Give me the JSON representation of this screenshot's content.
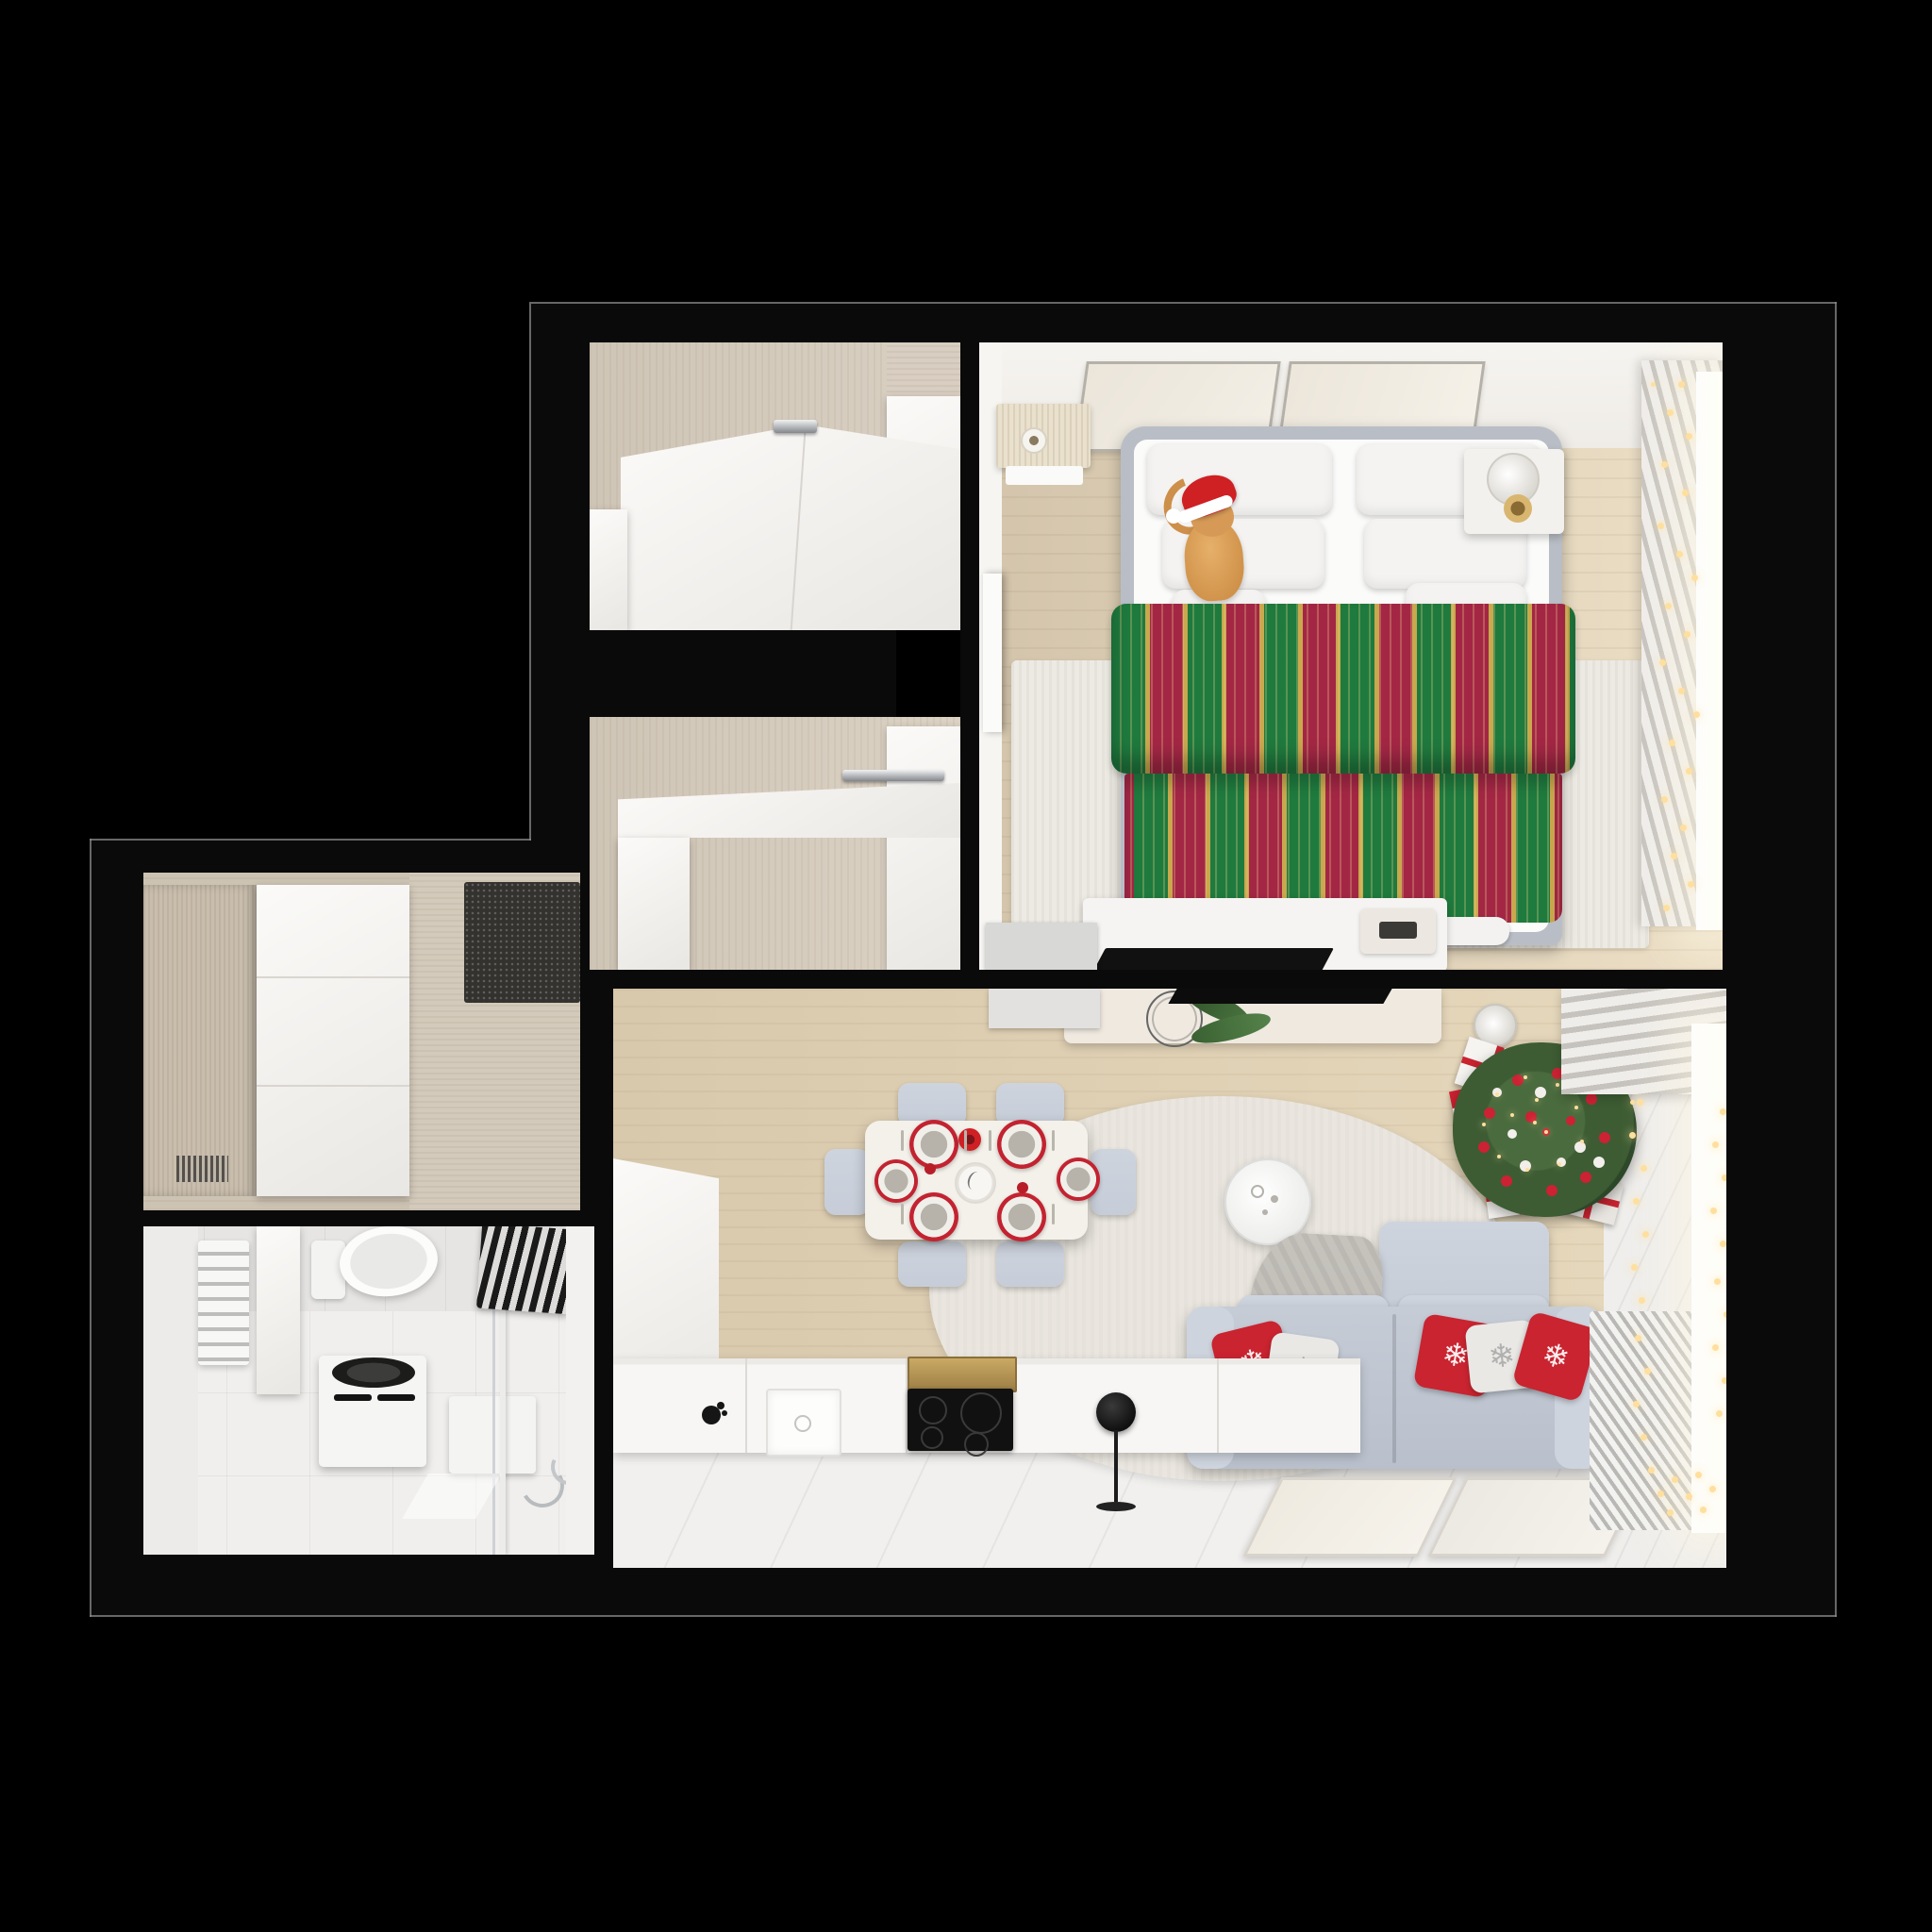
{
  "meta": {
    "title": "Top-down 3D render of a one-bedroom apartment floor plan with Christmas decorations",
    "view": "orthographic top-down",
    "style": "photorealistic architectural render on black background"
  },
  "palette": {
    "background": "#000000",
    "wall": "#0a0a0a",
    "outline": "#8a8a8a",
    "closet_floor": "#cfc5b6",
    "closet_wall": "#d8cec1",
    "bedroom_floor": "#d3c4ab",
    "bedroom_wall_band": "#f4f2ee",
    "hall_floor": "#cdc3b3",
    "bath_floor": "#f0efed",
    "bath_tile": "#e6e5e3",
    "living_floor": "#d8c8ac",
    "living_floor_white": "#f1f0ee",
    "cabinet_white": "#f7f6f4",
    "chrome": "#b9bcc0",
    "bed_frame": "#b9bec6",
    "mattress": "#fbfbfa",
    "pillow": "#f4f3f1",
    "blanket_green": "#1f7a3e",
    "blanket_red": "#a32745",
    "blanket_gold": "#c9a84e",
    "cat_fur": "#d79a56",
    "santa_red": "#cf2024",
    "rug": "#edeae3",
    "arc_rug": "#eae6df",
    "sofa": "#c6ccd6",
    "sofa_light": "#ced4de",
    "pillow_red": "#c92430",
    "pillow_white": "#e9e8e5",
    "throw_gray": "#bdbab4",
    "tree_green": "#3d5c33",
    "tree_dark": "#2c4628",
    "ornament_red": "#cc2233",
    "ornament_white": "#f2efec",
    "light_warm": "#ffdf9e",
    "table_white": "#f4f1ea",
    "chair_gray": "#c7cdd8",
    "plate_red": "#c32331",
    "plate_center": "#b7b3aa",
    "curtain_light": "#efedea",
    "curtain_dark": "#c6c3be",
    "radiator": "#f2f2f0",
    "radiator_dark": "#b9b8b5",
    "doormat": "#34322e",
    "appliance_black": "#111111",
    "hood_brass": "#b5924f",
    "console_cream": "#efe9e0",
    "window_white": "#ffffff",
    "gray_door": "#d8d8d6"
  },
  "rooms": {
    "walk_in_closet": {
      "name": "walk-in closet with white wardrobe"
    },
    "storage_closet": {
      "name": "second closet with built-in desk"
    },
    "bedroom": {
      "name": "bedroom with double bed, cat in santa hat, window garland"
    },
    "hallway": {
      "name": "entry hallway with wardrobe and doormat"
    },
    "bathroom": {
      "name": "bathroom with toilet, washing machine, radiator and shower"
    },
    "living_kitchen": {
      "name": "living room with kitchen, dining table, sofa and christmas tree"
    }
  },
  "objects": {
    "bedroom_items": [
      "double bed",
      "green-red striped holiday blanket",
      "six white pillows",
      "ginger cat wearing santa hat",
      "left nightstand with mug",
      "right nightstand with lamp and candle",
      "two wall art frames",
      "striped area rug",
      "dresser with flat tv",
      "digital clock",
      "pleated curtain",
      "window with fairy-light garland",
      "white door"
    ],
    "living_items": [
      "dining table with six red-rimmed plates",
      "red candle",
      "six gray chairs",
      "kitchen counter with sink and black faucet",
      "black cooktop with hood",
      "tall kitchen unit",
      "black floor lamp",
      "console with pine branch decor",
      "wall sconce",
      "flat tv over wall",
      "christmas tree with red and white ornaments",
      "gift boxes",
      "arc rug",
      "round white coffee table",
      "gray corner sofa",
      "red snowflake cushions",
      "gray throw",
      "two leaning art frames",
      "radiator",
      "window with string lights",
      "valance curtain"
    ],
    "bathroom_items": [
      "towel radiator",
      "toilet",
      "washing machine",
      "storage box",
      "shower glass with pole",
      "striped towel",
      "chrome taps"
    ],
    "hallway_items": [
      "wardrobe with wood side panel",
      "dark doormat"
    ],
    "closet_items": [
      "l-shaped white wardrobe",
      "chrome handles",
      "built-in white desk"
    ]
  },
  "decor": {
    "snowflake_glyph": "❄"
  }
}
